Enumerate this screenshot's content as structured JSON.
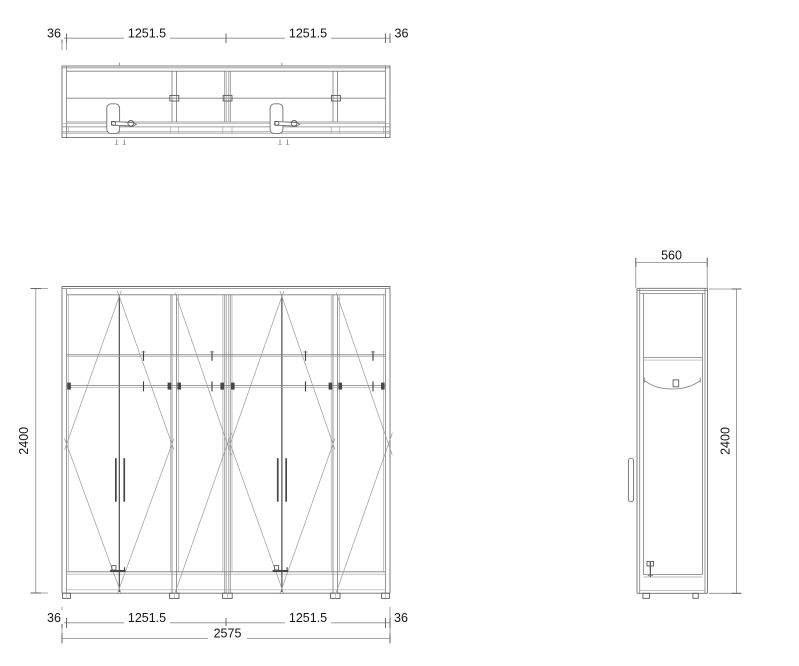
{
  "drawing": {
    "kind": "wardrobe-technical-drawing",
    "background": "#ffffff",
    "colors": {
      "line": "#6f6f6f",
      "dark_line": "#3c3c3c",
      "swing_line": "#9a9a9a",
      "dimension_text": "#141414"
    }
  },
  "dims": {
    "plan": {
      "left_panel": "36",
      "module_1": "1251.5",
      "module_2": "1251.5",
      "right_panel": "36"
    },
    "front": {
      "height": "2400",
      "left_panel": "36",
      "module_1": "1251.5",
      "module_2": "1251.5",
      "right_panel": "36",
      "total_width": "2575"
    },
    "side": {
      "depth": "560",
      "height": "2400"
    }
  }
}
